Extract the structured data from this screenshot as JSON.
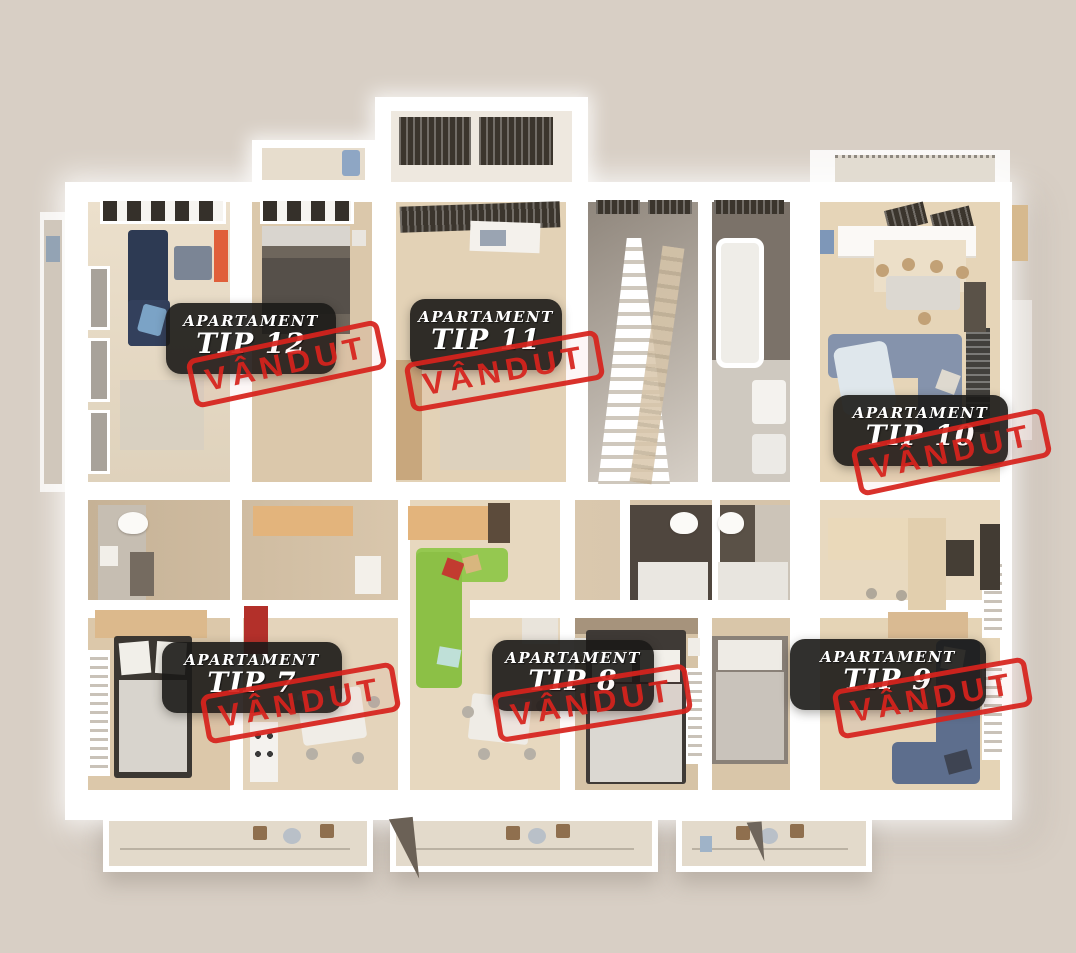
{
  "page": {
    "background_color": "#d8cfc5",
    "view": "3D top-down rendered floor plan of an apartment building level"
  },
  "apartments": [
    {
      "id": "tip-12",
      "title_line1": "APARTAMENT",
      "title_line2": "TIP 12",
      "status_stamp": "VÂNDUT"
    },
    {
      "id": "tip-11",
      "title_line1": "APARTAMENT",
      "title_line2": "TIP 11",
      "status_stamp": "VÂNDUT"
    },
    {
      "id": "tip-10",
      "title_line1": "APARTAMENT",
      "title_line2": "TIP 10",
      "status_stamp": "VÂNDUT"
    },
    {
      "id": "tip-7",
      "title_line1": "APARTAMENT",
      "title_line2": "TIP 7",
      "status_stamp": "VÂNDUT"
    },
    {
      "id": "tip-8",
      "title_line1": "APARTAMENT",
      "title_line2": "TIP 8",
      "status_stamp": "VÂNDUT"
    },
    {
      "id": "tip-9",
      "title_line1": "APARTAMENT",
      "title_line2": "TIP 9",
      "status_stamp": "VÂNDUT"
    }
  ],
  "colors": {
    "stamp_red": "#d7231d",
    "label_background": "#1b1917",
    "label_text": "#ffffff",
    "wall_white": "#ffffff",
    "floor_beige": "#e7d9c3"
  }
}
